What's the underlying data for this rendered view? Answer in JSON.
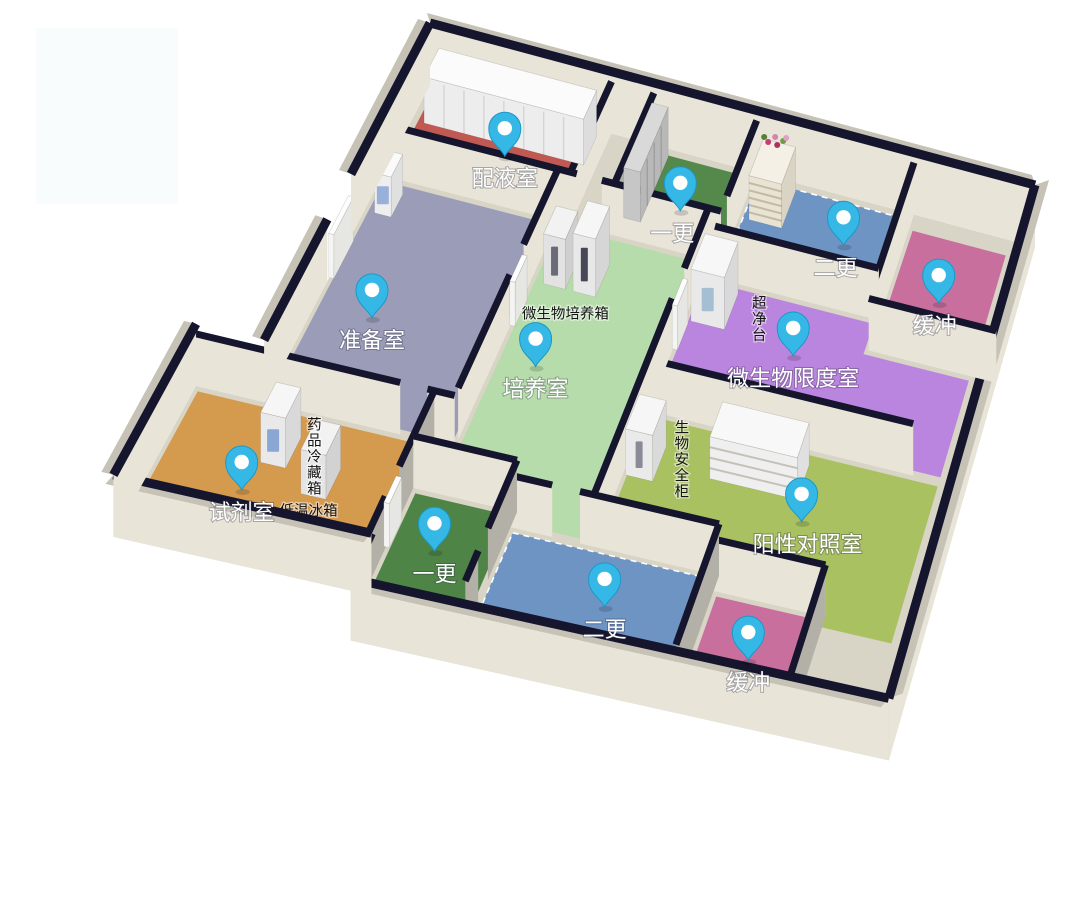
{
  "canvas": {
    "width": 1068,
    "height": 918,
    "background": "#ffffff"
  },
  "watermark": {
    "x": 36,
    "y": 28,
    "w": 142,
    "h": 176,
    "color": "#f8fcfd"
  },
  "projection": {
    "origin": [
      430,
      85
    ],
    "east": [
      6.05,
      1.62
    ],
    "south": [
      -3.95,
      7.55
    ],
    "perspective": 0.018,
    "wall_height_inner": 52,
    "wall_height_outer": 62
  },
  "palette": {
    "wall_cap": "#15152e",
    "wall_face_light": "#e9e4d8",
    "wall_face_gray": "#b3b0a8",
    "wall_band": "#c6c2b6",
    "slab": "#d8d4c6",
    "door_panel": "#fdfdfd"
  },
  "pin_style": {
    "fill": "#35b8e5",
    "stroke": "#1b98c8",
    "dot": "#ffffff"
  },
  "slab_poly": [
    [
      0,
      0
    ],
    [
      100,
      0
    ],
    [
      100,
      68
    ],
    [
      26,
      68
    ],
    [
      26,
      62
    ],
    [
      -10,
      62
    ],
    [
      -10,
      42
    ],
    [
      0,
      42
    ]
  ],
  "rooms": [
    {
      "id": "peiyeshi",
      "label": "配液室",
      "color": "#c05952",
      "poly": [
        [
          1,
          0.8
        ],
        [
          29,
          0.8
        ],
        [
          29,
          11.4
        ],
        [
          1,
          11.4
        ]
      ],
      "pin": [
        16,
        6
      ],
      "ldx": 0
    },
    {
      "id": "zhunbeishi",
      "label": "准备室",
      "color": "#9b9db8",
      "poly": [
        [
          0.6,
          12.6
        ],
        [
          27.4,
          12.6
        ],
        [
          27.4,
          41.4
        ],
        [
          0.6,
          41.4
        ]
      ],
      "pin": [
        8.6,
        29
      ],
      "ldx": 0
    },
    {
      "id": "shijishi",
      "label": "试剂室",
      "color": "#d49a4e",
      "poly": [
        [
          -9.4,
          42.6
        ],
        [
          24.4,
          42.6
        ],
        [
          24.4,
          61.4
        ],
        [
          -9.4,
          61.4
        ]
      ],
      "pin": [
        3,
        53
      ],
      "ldx": 0
    },
    {
      "id": "peiyangshi",
      "label": "培养室",
      "color": "#b7dcab",
      "poly": [
        [
          28.6,
          12.6
        ],
        [
          51.4,
          12.6
        ],
        [
          51.4,
          49.4
        ],
        [
          40.6,
          49.4
        ],
        [
          40.6,
          47.4
        ],
        [
          28.6,
          47.4
        ]
      ],
      "pin": [
        34,
        30
      ],
      "ldx": 0
    },
    {
      "id": "yigeng-top",
      "label": "一更",
      "color": "#55884b",
      "poly": [
        [
          37.6,
          0.8
        ],
        [
          53.4,
          0.8
        ],
        [
          53.4,
          11.4
        ],
        [
          37.6,
          11.4
        ]
      ],
      "pin": [
        45,
        7
      ],
      "ldx": -8
    },
    {
      "id": "ergeng-top",
      "label": "二更",
      "color": "#6e94c4",
      "poly": [
        [
          54.6,
          0.8
        ],
        [
          79.4,
          0.8
        ],
        [
          79.4,
          13.4
        ],
        [
          54.6,
          13.4
        ]
      ],
      "pin": [
        71,
        6
      ],
      "ldx": -8,
      "dashed": true
    },
    {
      "id": "huanchong-top",
      "label": "缓冲",
      "color": "#c96f9d",
      "poly": [
        [
          80.6,
          2
        ],
        [
          95.9,
          2
        ],
        [
          95.9,
          17.4
        ],
        [
          80.6,
          17.4
        ]
      ],
      "pin": [
        88,
        10
      ],
      "ldx": -4
    },
    {
      "id": "weishengwu-xiandushi",
      "label": "微生物限度室",
      "color": "#ba85de",
      "poly": [
        [
          52.6,
          14.6
        ],
        [
          79.4,
          14.6
        ],
        [
          79.4,
          18.6
        ],
        [
          95.9,
          18.6
        ],
        [
          95.9,
          31.4
        ],
        [
          52.6,
          31.4
        ]
      ],
      "pin": [
        69.4,
        21
      ],
      "ldx": 0
    },
    {
      "id": "yangxing-duizhaoshi",
      "label": "阳性对照室",
      "color": "#a9c161",
      "poly": [
        [
          52.6,
          32.6
        ],
        [
          95.9,
          32.6
        ],
        [
          95.9,
          53.4
        ],
        [
          85.6,
          53.4
        ],
        [
          85.6,
          51.8
        ],
        [
          69.6,
          51.8
        ],
        [
          69.6,
          49.8
        ],
        [
          52.6,
          49.8
        ]
      ],
      "pin": [
        78.6,
        41
      ],
      "ldx": 6
    },
    {
      "id": "yigeng-bottom",
      "label": "一更",
      "color": "#4f8447",
      "poly": [
        [
          25.6,
          48.6
        ],
        [
          39.4,
          48.6
        ],
        [
          39.4,
          63.4
        ],
        [
          25.6,
          63.4
        ]
      ],
      "pin": [
        31.5,
        55
      ],
      "ldx": 0
    },
    {
      "id": "ergeng-bottom",
      "label": "二更",
      "color": "#6e94c4",
      "poly": [
        [
          40.6,
          50.6
        ],
        [
          69.4,
          50.6
        ],
        [
          69.4,
          65.4
        ],
        [
          40.6,
          65.4
        ]
      ],
      "pin": [
        56.5,
        57
      ],
      "ldx": 0,
      "dashed": true
    },
    {
      "id": "huanchong-bottom",
      "label": "缓冲",
      "color": "#c96f9d",
      "poly": [
        [
          70.6,
          52.6
        ],
        [
          85.4,
          52.6
        ],
        [
          85.4,
          67.4
        ],
        [
          70.6,
          67.4
        ]
      ],
      "pin": [
        77.7,
        59.5
      ],
      "ldx": 0
    }
  ],
  "walls_back": [
    {
      "a": [
        0,
        0
      ],
      "b": [
        100,
        0
      ],
      "h": 62,
      "band": [
        -3,
        -10
      ]
    },
    {
      "a": [
        100,
        0
      ],
      "b": [
        100,
        68
      ],
      "h": 62,
      "band": [
        14,
        -5
      ]
    }
  ],
  "walls_inner": [
    {
      "a": [
        30,
        0
      ],
      "b": [
        30,
        12
      ]
    },
    {
      "a": [
        37,
        0
      ],
      "b": [
        37,
        12
      ],
      "g": true
    },
    {
      "a": [
        54,
        0
      ],
      "b": [
        54,
        10
      ]
    },
    {
      "a": [
        80,
        0
      ],
      "b": [
        80,
        18
      ]
    },
    {
      "a": [
        0,
        12
      ],
      "b": [
        31,
        12
      ]
    },
    {
      "a": [
        35,
        12
      ],
      "b": [
        54,
        12
      ]
    },
    {
      "a": [
        54,
        14
      ],
      "b": [
        80,
        14
      ]
    },
    {
      "a": [
        80,
        18
      ],
      "b": [
        100,
        18
      ]
    },
    {
      "a": [
        28,
        12
      ],
      "b": [
        28,
        22
      ]
    },
    {
      "a": [
        28,
        26
      ],
      "b": [
        28,
        41
      ]
    },
    {
      "a": [
        52,
        12
      ],
      "b": [
        52,
        20
      ]
    },
    {
      "a": [
        52,
        24
      ],
      "b": [
        52,
        50
      ]
    },
    {
      "a": [
        52,
        32
      ],
      "b": [
        92,
        32
      ]
    },
    {
      "a": [
        -10,
        42
      ],
      "b": [
        20,
        42
      ]
    },
    {
      "a": [
        24,
        42
      ],
      "b": [
        28,
        42
      ]
    },
    {
      "a": [
        25,
        42
      ],
      "b": [
        25,
        52
      ],
      "g": true
    },
    {
      "a": [
        25,
        56
      ],
      "b": [
        25,
        63
      ],
      "g": true
    },
    {
      "a": [
        25,
        48
      ],
      "b": [
        40,
        48
      ]
    },
    {
      "a": [
        40,
        48
      ],
      "b": [
        40,
        57
      ],
      "g": true
    },
    {
      "a": [
        40,
        60
      ],
      "b": [
        40,
        64
      ],
      "g": true
    },
    {
      "a": [
        40,
        50
      ],
      "b": [
        46,
        50
      ]
    },
    {
      "a": [
        50,
        50
      ],
      "b": [
        70,
        50
      ]
    },
    {
      "a": [
        70,
        50
      ],
      "b": [
        70,
        66
      ],
      "g": true
    },
    {
      "a": [
        70,
        52
      ],
      "b": [
        86,
        52
      ]
    },
    {
      "a": [
        86,
        52
      ],
      "b": [
        86,
        68
      ],
      "g": true
    }
  ],
  "walls_front": [
    {
      "a": [
        100,
        68
      ],
      "b": [
        26,
        68
      ],
      "h": 62,
      "band": [
        -8,
        9
      ]
    },
    {
      "a": [
        26,
        68
      ],
      "b": [
        26,
        62
      ],
      "h": 62
    },
    {
      "a": [
        26,
        62
      ],
      "b": [
        -10,
        62
      ],
      "h": 62,
      "band": [
        -8,
        9
      ]
    },
    {
      "a": [
        -10,
        62
      ],
      "b": [
        -10,
        42
      ],
      "h": 62,
      "band": [
        -12,
        -3
      ]
    },
    {
      "a": [
        0,
        20
      ],
      "b": [
        0,
        0
      ],
      "h": 62,
      "band": [
        -12,
        -4
      ]
    },
    {
      "a": [
        0,
        26
      ],
      "b": [
        0,
        42
      ],
      "h": 62,
      "band": [
        -12,
        -4
      ]
    }
  ],
  "doors": [
    {
      "id": "door-prep-culture",
      "rect": [
        27.9,
        22.3,
        28.7,
        25.8
      ],
      "h": 44
    },
    {
      "id": "door-culture-east",
      "rect": [
        51.9,
        20.3,
        52.7,
        23.8
      ],
      "h": 44
    },
    {
      "id": "door-reagent",
      "rect": [
        24.7,
        52.3,
        25.5,
        55.8
      ],
      "h": 44
    },
    {
      "id": "door-west",
      "rect": [
        -0.1,
        20.5,
        0.7,
        25.5
      ],
      "h": 44
    }
  ],
  "equipment": [
    {
      "id": "cabinet-row",
      "rect": [
        2,
        0.8,
        28,
        4.6
      ],
      "h": 46,
      "top": "#fbfbfb",
      "front": "#ededed",
      "side": "#dddddd",
      "seams": 8
    },
    {
      "id": "prep-unit",
      "rect": [
        1.6,
        13.6,
        4.2,
        16.6
      ],
      "h": 40,
      "top": "#fafafa",
      "front": "#eeeeee",
      "side": "#e0e0e0",
      "accent": "#8fa8d8"
    },
    {
      "id": "lockers",
      "rect": [
        37.2,
        1,
        39.9,
        9.6
      ],
      "h": 50,
      "top": "#d9d9d9",
      "front": "#c6c6c6",
      "side": "#b8b8b8",
      "seams_side": 4
    },
    {
      "id": "shoe-rack",
      "rect": [
        55.6,
        1,
        60.9,
        5.9
      ],
      "h": 44,
      "top": "#f5f0e5",
      "front": "#e9e3d3",
      "side": "#dad4c4",
      "tiers": 5,
      "flowers": [
        "#c43f74",
        "#d684ad",
        "#6f9a45",
        "#b03060",
        "#e0a0c0",
        "#557f35"
      ]
    },
    {
      "id": "clean-bench",
      "rect": [
        53,
        15.2,
        58.2,
        19.9
      ],
      "h": 52,
      "top": "#f7f7f7",
      "front": "#e9e9e9",
      "side": "#d9d9d9",
      "accent": "#9fb9cf"
    },
    {
      "id": "incubator-1",
      "rect": [
        30,
        16.2,
        33.4,
        19.9
      ],
      "h": 50,
      "top": "#f2f2f2",
      "front": "#e2e2e2",
      "side": "#cfcfcf",
      "slit": "#6a6a78"
    },
    {
      "id": "incubator-2",
      "rect": [
        34.6,
        15.6,
        38.1,
        19.9
      ],
      "h": 58,
      "top": "#f6f6f6",
      "front": "#e8e8e8",
      "side": "#d6d6d6",
      "slit": "#474757"
    },
    {
      "id": "medicine-fridge",
      "rect": [
        3.6,
        45.2,
        7.2,
        49.2
      ],
      "h": 50,
      "top": "#f6f6f6",
      "front": "#e9e9e9",
      "side": "#d9d9d9",
      "accent": "#7f9fd0"
    },
    {
      "id": "freezer",
      "rect": [
        10.8,
        47.8,
        14.4,
        51.8
      ],
      "h": 44,
      "top": "#f2f2f2",
      "front": "#e4e4e4",
      "side": "#d2d2d2"
    },
    {
      "id": "biosafety-cabinet",
      "rect": [
        52.4,
        35.8,
        56.4,
        40.4
      ],
      "h": 46,
      "top": "#f6f6f6",
      "front": "#eaeaea",
      "side": "#dadada",
      "slit": "#8a8a96"
    },
    {
      "id": "tier-shelf",
      "rect": [
        64,
        33.8,
        77,
        38.4
      ],
      "h": 42,
      "top": "#f8f8f8",
      "front": "#efefef",
      "side": "#e0e0e0",
      "tiers": 3
    }
  ],
  "equipment_labels": [
    {
      "id": "label-incubator",
      "text": "微生物培养箱",
      "u": 35.2,
      "v": 23.4,
      "vertical": false
    },
    {
      "id": "label-clean-bench",
      "text": "超净台",
      "u": 62,
      "v": 16.2,
      "vertical": true
    },
    {
      "id": "label-biosafety",
      "text": "生物安全柜",
      "u": 57.8,
      "v": 33.6,
      "vertical": true
    },
    {
      "id": "label-medicine-fridge",
      "text": "药品冷藏箱",
      "u": 8.4,
      "v": 43.8,
      "vertical": true
    },
    {
      "id": "label-freezer",
      "text": "低温冰箱",
      "u": 13.2,
      "v": 54.2,
      "vertical": false
    }
  ]
}
